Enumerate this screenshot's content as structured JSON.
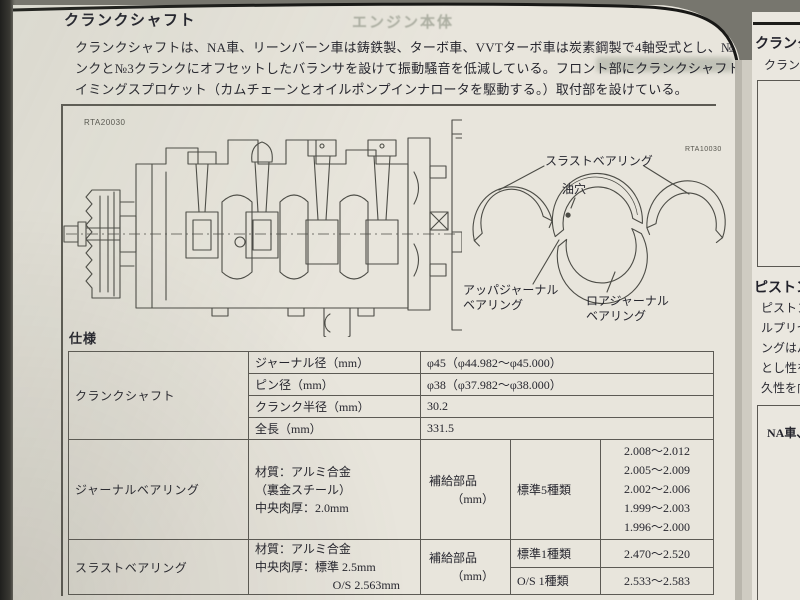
{
  "doc": {
    "title": "クランクシャフト",
    "watermark": "エンジン本体",
    "intro": {
      "line1": "クランクシャフトは、NA車、リーンバーン車は鋳鉄製、ターボ車、VVTターボ車は炭素鋼製で4軸受式とし、№1クラ",
      "line2": "ンクと№3クランクにオフセットしたバランサを設けて振動騒音を低減している。フロント部にクランクシャフトタ",
      "line3": "イミングスプロケット（カムチェーンとオイルポンプインナロータを駆動する。）取付部を設けている。"
    },
    "figure": {
      "code_left": "RTA20030",
      "code_right": "RTA10030",
      "label_thrust": "スラストベアリング",
      "label_oil_hole": "油穴",
      "label_upper_1": "アッパジャーナル",
      "label_upper_2": "ベアリング",
      "label_lower_1": "ロアジャーナル",
      "label_lower_2": "ベアリング"
    },
    "spec_heading": "仕様",
    "table": {
      "crank": {
        "title": "クランクシャフト",
        "rows": [
          {
            "label": "ジャーナル径（mm）",
            "value": "φ45（φ44.982～φ45.000）"
          },
          {
            "label": "ピン径（mm）",
            "value": "φ38（φ37.982～φ38.000）"
          },
          {
            "label": "クランク半径（mm）",
            "value": "30.2"
          },
          {
            "label": "全長（mm）",
            "value": "331.5"
          }
        ]
      },
      "journal": {
        "title": "ジャーナルベアリング",
        "material": [
          "材質：アルミ合金",
          "（裏金スチール）",
          "中央肉厚：2.0mm"
        ],
        "supply": "補給部品",
        "unit": "（mm）",
        "kind": "標準5種類",
        "values": [
          "2.008～2.012",
          "2.005～2.009",
          "2.002～2.006",
          "1.999～2.003",
          "1.996～2.000"
        ]
      },
      "thrust": {
        "title": "スラストベアリング",
        "material": [
          "材質：アルミ合金",
          "中央肉厚：標準 2.5mm",
          "O/S 2.563mm"
        ],
        "supply": "補給部品",
        "unit": "（mm）",
        "rows": [
          {
            "kind": "標準1種類",
            "value": "2.470～2.520"
          },
          {
            "kind": "O/S 1種類",
            "value": "2.533～2.583"
          }
        ]
      }
    }
  },
  "next_page": {
    "title": "クランクシ",
    "intro": "クランクシ",
    "section2": "ピストン",
    "lines": [
      "ピストン",
      "ルプリセ",
      "ングはパ",
      "とし性を",
      "久性を向"
    ],
    "box_label": "NA車、"
  }
}
